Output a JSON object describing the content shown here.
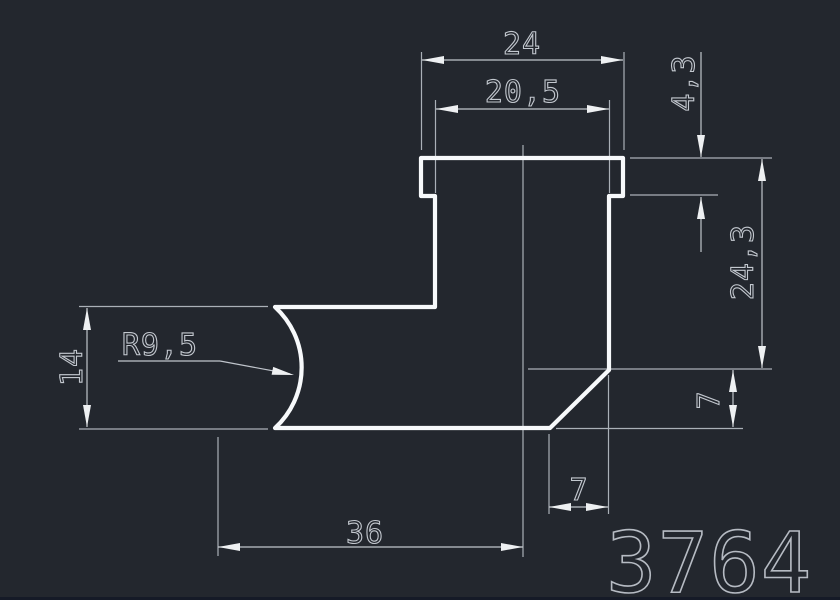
{
  "app": {
    "background_color": "#23272e",
    "footer_bar_color": "#151a27"
  },
  "drawing": {
    "part_number": "3764",
    "geometry_color": "#f7f9fb",
    "dimension_color": "#c0c5cc",
    "dimensions": {
      "outer_width": "24",
      "inner_width": "20,5",
      "flange_thickness": "4,3",
      "right_height": "24,3",
      "chamfer_vertical": "7",
      "left_height": "14",
      "radius": "R9,5",
      "chamfer_horizontal": "7",
      "base_length": "36"
    }
  }
}
